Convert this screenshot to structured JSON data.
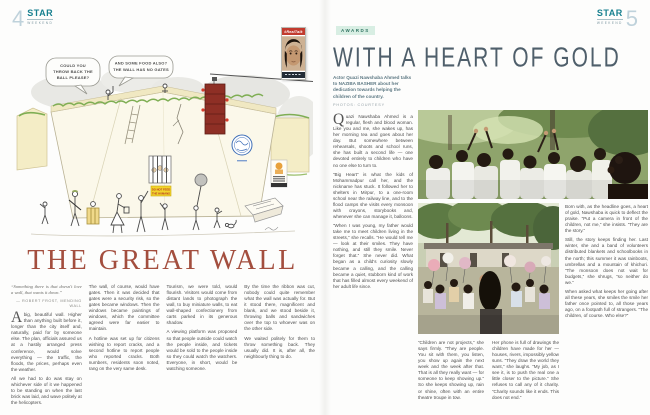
{
  "colors": {
    "brand_teal": "#17808f",
    "page_number_blue": "#bfd2db",
    "headline_red": "#a34e3e",
    "headline_slate": "#4f5f6b",
    "tag_bg": "#d8eee3",
    "tag_text": "#2f7361",
    "sign_yellow": "#f2d42c",
    "badge_red": "#c23b2e"
  },
  "left_page": {
    "page_number": "4",
    "masthead": {
      "brand": "STAR",
      "sub": "WEEKEND"
    },
    "cartoon": {
      "speech_bubble_1": {
        "l1": "COULD YOU",
        "l2": "THROW BACK THE",
        "l3": "BALL PLEASE?"
      },
      "speech_bubble_2": {
        "l1": "AND SOME FOOD ALSO?",
        "l2": "THE WALL HAS NO GATES"
      },
      "wall_sign": {
        "l1": "DO NOT FEED",
        "l2": "THE HUMANS"
      },
      "badge": {
        "label": "#RealTalk"
      }
    },
    "headline": "THE GREAT WALL",
    "epigraph": {
      "text": "“Something there is that doesn't love a wall, that wants it down.”",
      "attribution": "— ROBERT FROST, MENDING WALL"
    },
    "columns": {
      "c1": {
        "dropcap": "A",
        "p1": " big, beautiful wall. Higher than anything built before it, longer than the city itself and, naturally, paid for by someone else. The plan, officials assured us at a hastily arranged press conference, would solve everything — the traffic, the floods, the prices, perhaps even the weather.",
        "p2": "All we had to do was stay on whichever side of it we happened to be standing on when the last brick was laid, and wave politely at the helicopters."
      },
      "c2": {
        "p1": "The wall, of course, would have gates. Then it was decided that gates were a security risk, so the gates became windows. Then the windows became paintings of windows, which the committee agreed were far easier to maintain.",
        "p2": "A hotline was set up for citizens wishing to report cracks, and a second hotline to report people who reported cracks. Both numbers, residents soon noted, rang on the very same desk."
      },
      "c3": {
        "p1": "Tourism, we were told, would flourish. Visitors would come from distant lands to photograph the wall, to buy miniature walls, to eat wall-shaped confectionery from carts parked in its generous shadow.",
        "p2": "A viewing platform was proposed so that people outside could watch the people inside, and tickets would be sold to the people inside so they could watch the watchers. Everyone, in short, would be watching someone."
      },
      "c4": {
        "p1": "By the time the ribbon was cut, nobody could quite remember what the wall was actually for. But it stood there, magnificent and blank, and we stood beside it, throwing balls and sandwiches over the top to whoever was on the other side.",
        "p2": "We waited politely for them to throw something back. They usually did. It is, after all, the neighbourly thing to do."
      }
    }
  },
  "right_page": {
    "page_number": "5",
    "masthead": {
      "brand": "STAR",
      "sub": "WEEKEND"
    },
    "tag": "AWARDS",
    "headline": "WITH A HEART OF GOLD",
    "standfirst": "Actor Quazi Nawshaba Ahmed talks to NAZIBA BASHER about her dedication towards helping the children of the country.",
    "credit": "PHOTOS: COURTESY",
    "columns": {
      "c1": {
        "dropcap": "Q",
        "p1": "uazi Nawshaba Ahmed is a regular, flesh and blood woman. Like you and me, she wakes up, has her morning tea and goes about her day. But somewhere between rehearsals, shoots and school runs, she has built a second life — one devoted entirely to children who have no one else to turn to.",
        "p2": "“Big Heart” is what the kids of Mohammadpur call her, and the nickname has stuck. It followed her to shelters in Mirpur, to a one-room school near the railway line, and to the flood camps she visits every monsoon with crayons, storybooks and, whenever she can manage it, balloons.",
        "p3": "“When I was young, my father would take me to meet children living in the streets,” she recalls. “He would tell me — look at their smiles. They have nothing, and still they smile. Never forget that.” She never did. What began as a child's curiosity slowly became a calling, and the calling became a quiet, stubborn kind of work that has filled almost every weekend of her adult life since."
      },
      "c2a": {
        "p1": "“Children are not projects,” she says firmly. “They are people. You sit with them, you listen, you show up again the next week and the week after that. That is all they really want — for someone to keep showing up.” So she keeps showing up, rain or shine, often with an entire theatre troupe in tow."
      },
      "c2b": {
        "p1": "Her phone is full of drawings the children have made for her — houses, rivers, impossibly yellow suns. “They draw the world they want,” she laughs. “My job, as I see it, is to push the real one a little closer to the picture.” She refuses to call any of it charity. “Charity sounds like it ends. This does not end.”"
      },
      "c3": {
        "p1": "Born with, as the headline goes, a heart of gold, Nawshaba is quick to deflect the praise. “Put a camera in front of the children, not me,” she insists. “They are the story.”",
        "p2": "Still, the story keeps finding her. Last winter, she and a band of volunteers distributed blankets and schoolbooks in the north; this summer it was rainboots, umbrellas and a mountain of khichuri. “The monsoon does not wait for budgets,” she shrugs, “so neither do we.”",
        "p3": "When asked what keeps her going after all these years, she smiles the smile her father once pointed to, all those years ago, on a footpath full of strangers. “The children, of course. Who else?”"
      }
    }
  }
}
